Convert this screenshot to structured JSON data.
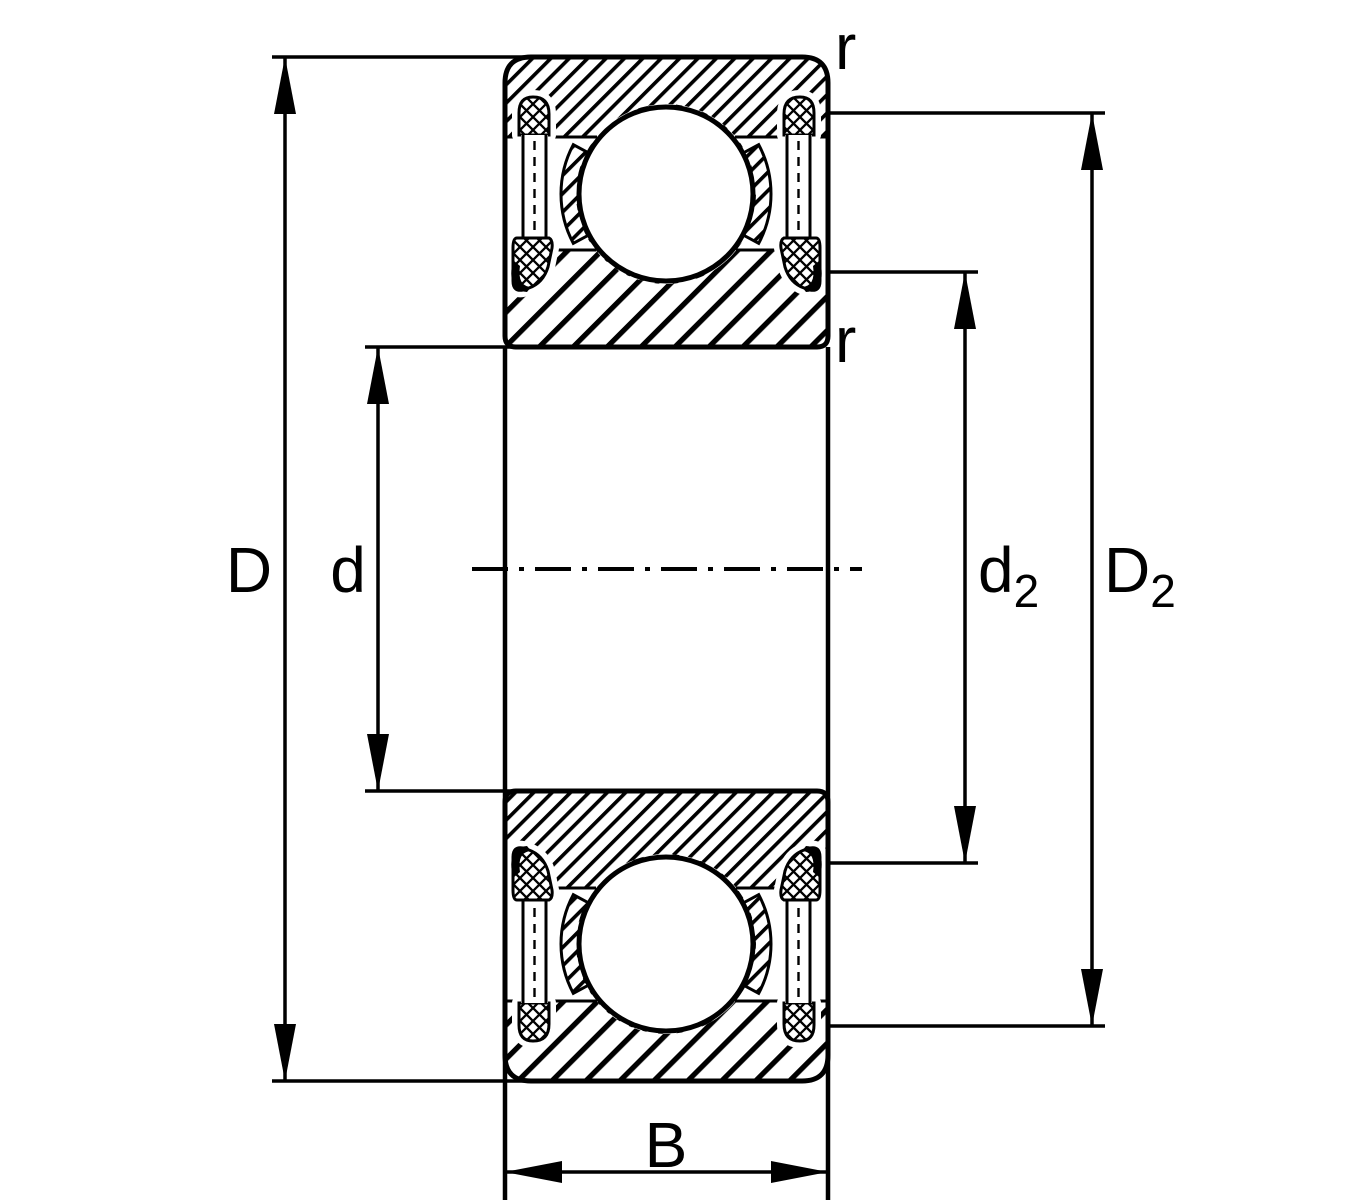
{
  "drawing": {
    "type": "bearing-cross-section",
    "description": "Sealed deep groove ball bearing dimension drawing, axial cross-section with centerline",
    "colors": {
      "line": "#000000",
      "background": "#ffffff"
    },
    "dimensions": {
      "outer_diameter": {
        "label": "D"
      },
      "bore_diameter": {
        "label": "d"
      },
      "inner_recess": {
        "label": "d",
        "subscript": "2"
      },
      "outer_recess": {
        "label": "D",
        "subscript": "2"
      },
      "width": {
        "label": "B"
      },
      "chamfer_outer": {
        "label": "r"
      },
      "chamfer_inner": {
        "label": "r"
      }
    }
  }
}
